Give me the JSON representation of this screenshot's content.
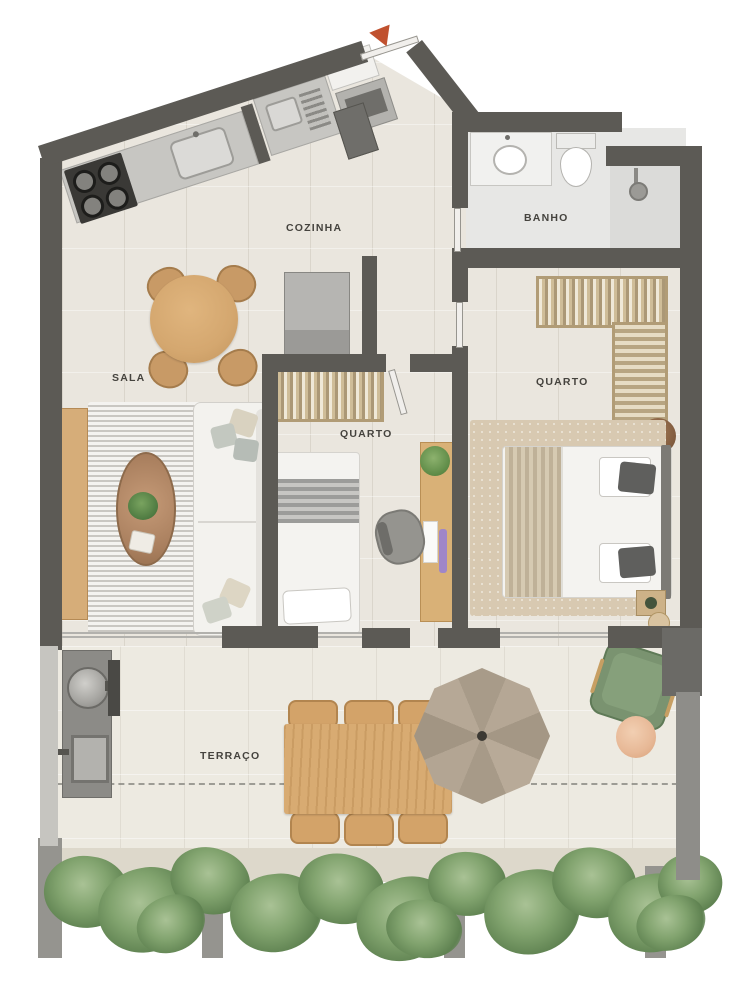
{
  "rooms": [
    {
      "id": "cozinha",
      "label": "COZINHA"
    },
    {
      "id": "banho",
      "label": "BANHO"
    },
    {
      "id": "sala",
      "label": "SALA"
    },
    {
      "id": "quarto-1",
      "label": "QUARTO"
    },
    {
      "id": "quarto-2",
      "label": "QUARTO"
    },
    {
      "id": "terraco",
      "label": "TERRAÇO"
    }
  ],
  "entrance": {
    "marker": "entrance-arrow"
  },
  "palette": {
    "wall": "#5c5a55",
    "floor": "#eae6de",
    "bath_floor": "#e8e8e6",
    "terrace_floor": "#edeae1",
    "wood": "#d7ab73",
    "rug_bedroom": "#d8c9b1",
    "greenery": "#7fa06c",
    "entrance_arrow": "#c0512f",
    "label_text": "#45433e",
    "parasol": "#b1a492",
    "lounge_chair_green": "#7a9370",
    "pouf_peach": "#eac3a5"
  }
}
